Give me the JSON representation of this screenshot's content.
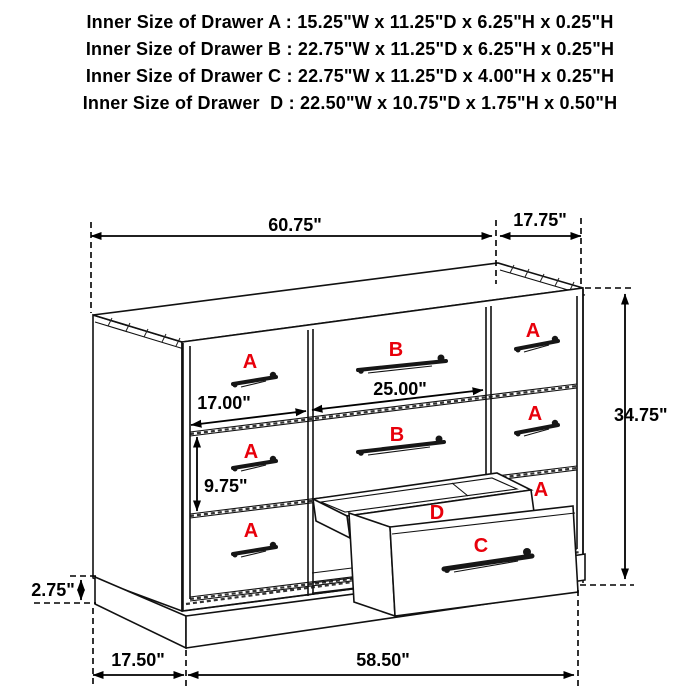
{
  "specs": {
    "lines": [
      "Inner Size of Drawer A : 15.25\"W x 11.25\"D x 6.25\"H x 0.25\"H",
      "Inner Size of Drawer B : 22.75\"W x 11.25\"D x 6.25\"H x 0.25\"H",
      "Inner Size of Drawer C : 22.75\"W x 11.25\"D x 4.00\"H x 0.25\"H",
      "Inner Size of Drawer  D : 22.50\"W x 10.75\"D x 1.75\"H x 0.50\"H"
    ]
  },
  "diagram": {
    "dims": {
      "overall_width": "60.75\"",
      "top_depth": "17.75\"",
      "height": "34.75\"",
      "drawer_b_width": "25.00\"",
      "drawer_a_width": "17.00\"",
      "drawer_a_height": "9.75\"",
      "base_height": "2.75\"",
      "base_depth": "17.50\"",
      "base_width": "58.50\""
    },
    "labels": {
      "a": "A",
      "b": "B",
      "c": "C",
      "d": "D"
    },
    "colors": {
      "label_red": "#e8000b",
      "line": "#111111",
      "background": "#ffffff"
    }
  }
}
